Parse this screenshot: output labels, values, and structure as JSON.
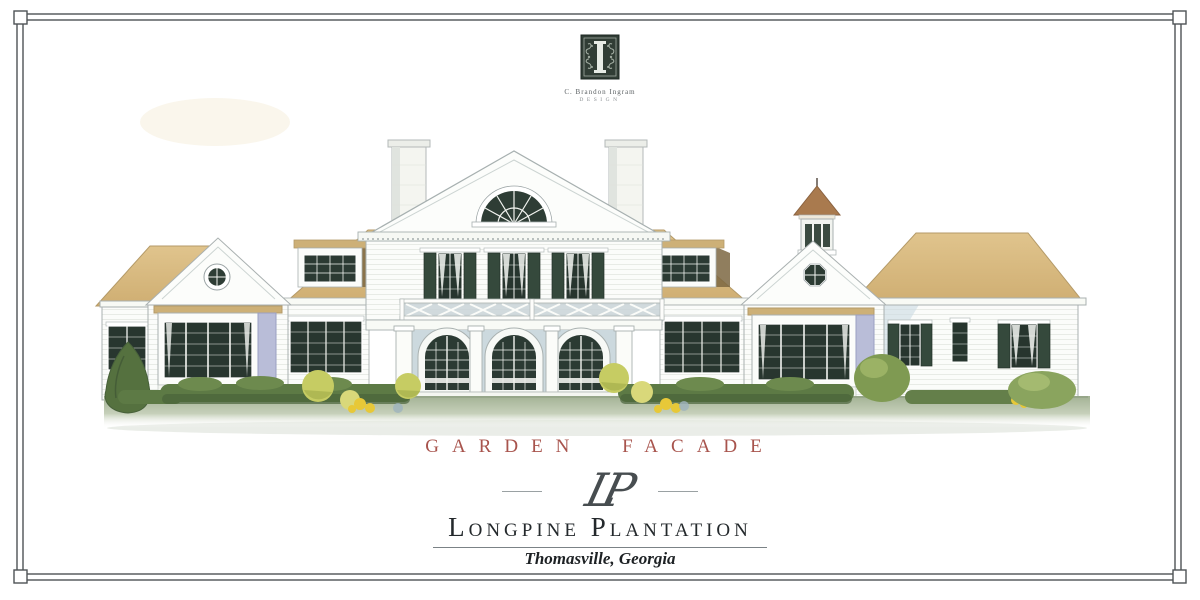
{
  "logo": {
    "mark": "ornamental-initial-block",
    "studio_name": "C. Brandon Ingram",
    "studio_subtitle": "DESIGN"
  },
  "caption": {
    "text": "GARDEN FACADE"
  },
  "monogram": {
    "text": "LP"
  },
  "title": {
    "text": "Longpine Plantation"
  },
  "location": {
    "text": "Thomasville, Georgia"
  },
  "illustration": {
    "type": "watercolor architectural elevation",
    "features": [
      "central pediment with fan window",
      "twin white brick chimneys",
      "second-floor windows with dark green shutters",
      "cross balustrade balcony",
      "three arched french doors",
      "terrace steps",
      "gabled side pavilions with round windows",
      "box bay windows",
      "shed dormers",
      "cupola",
      "long right service wing",
      "boxwood hedges, yellow-green shrubs and tall evergreen"
    ]
  },
  "colors": {
    "accent_red": "#a8544d",
    "roof_tan": "#d6b77d",
    "shutter_green": "#35493c",
    "foliage_green": "#5d7a45",
    "yellow_shrub": "#c6cc63",
    "wall_white": "#fbfcfa",
    "shadow_blue": "#ccd9de",
    "lavender_shadow": "#b9bdd8",
    "grass_green": "#a3b295",
    "text_dark": "#24292c",
    "monogram": "#474d50",
    "border": "#4e5356"
  }
}
